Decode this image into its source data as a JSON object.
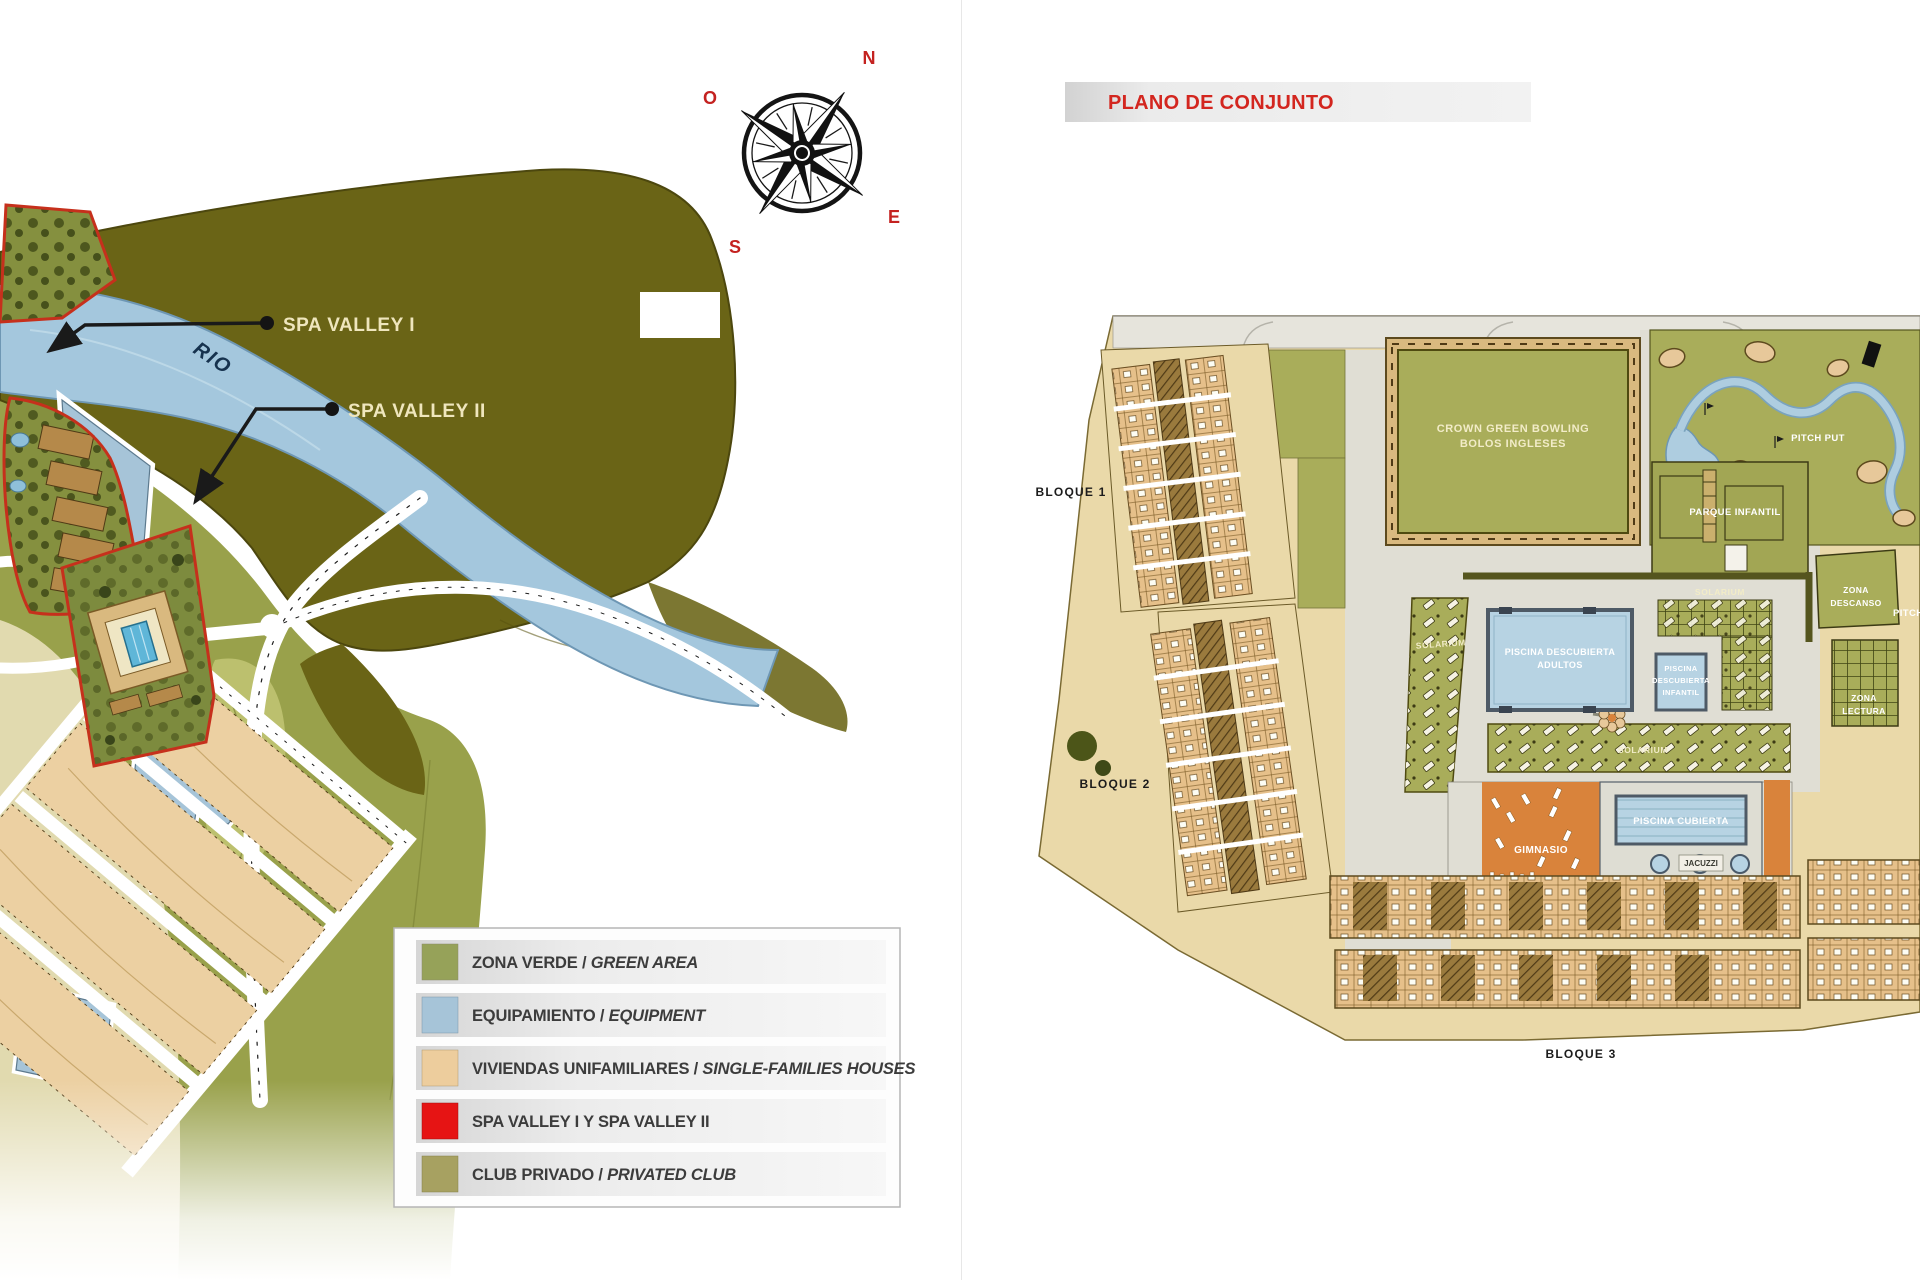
{
  "plan": {
    "title": "PLANO DE CONJUNTO",
    "blocks": [
      {
        "label": "BLOQUE 1"
      },
      {
        "label": "BLOQUE 2"
      },
      {
        "label": "BLOQUE 3"
      }
    ],
    "areas": {
      "bowling_line1": "CROWN GREEN BOWLING",
      "bowling_line2": "BOLOS INGLESES",
      "pitch_put": "PITCH PUT",
      "pitch": "PITCH",
      "parque_infantil": "PARQUE INFANTIL",
      "zona_descanso_line1": "ZONA",
      "zona_descanso_line2": "DESCANSO",
      "zona_lectura_line1": "ZONA",
      "zona_lectura_line2": "LECTURA",
      "solarium": "SOLARIUM",
      "piscina_adultos_line1": "PISCINA DESCUBIERTA",
      "piscina_adultos_line2": "ADULTOS",
      "piscina_infantil_line1": "PISCINA",
      "piscina_infantil_line2": "DESCUBIERTA",
      "piscina_infantil_line3": "INFANTIL",
      "piscina_cubierta": "PISCINA CUBIERTA",
      "gimnasio": "GIMNASIO",
      "jacuzzi": "JACUZZI"
    }
  },
  "site_map": {
    "river_label": "RIO",
    "callouts": [
      {
        "label": "SPA VALLEY I"
      },
      {
        "label": "SPA VALLEY II"
      }
    ]
  },
  "compass": {
    "n": "N",
    "s": "S",
    "e": "E",
    "o": "O"
  },
  "legend": {
    "items": [
      {
        "label": "ZONA VERDE",
        "sep": " / ",
        "label_en": "GREEN AREA",
        "color": "#96a259"
      },
      {
        "label": "EQUIPAMIENTO",
        "sep": " / ",
        "label_en": "EQUIPMENT",
        "color": "#a6c4d8"
      },
      {
        "label": "VIVIENDAS UNIFAMILIARES",
        "sep": " / ",
        "label_en": "SINGLE-FAMILIES HOUSES",
        "color": "#edcd9d"
      },
      {
        "label": "SPA VALLEY I Y SPA VALLEY II",
        "sep": "",
        "label_en": "",
        "color": "#e61414"
      },
      {
        "label": "CLUB PRIVADO",
        "sep": " / ",
        "label_en": "PRIVATED CLUB",
        "color": "#a7a161"
      }
    ],
    "accent_red": "#d3261f"
  }
}
